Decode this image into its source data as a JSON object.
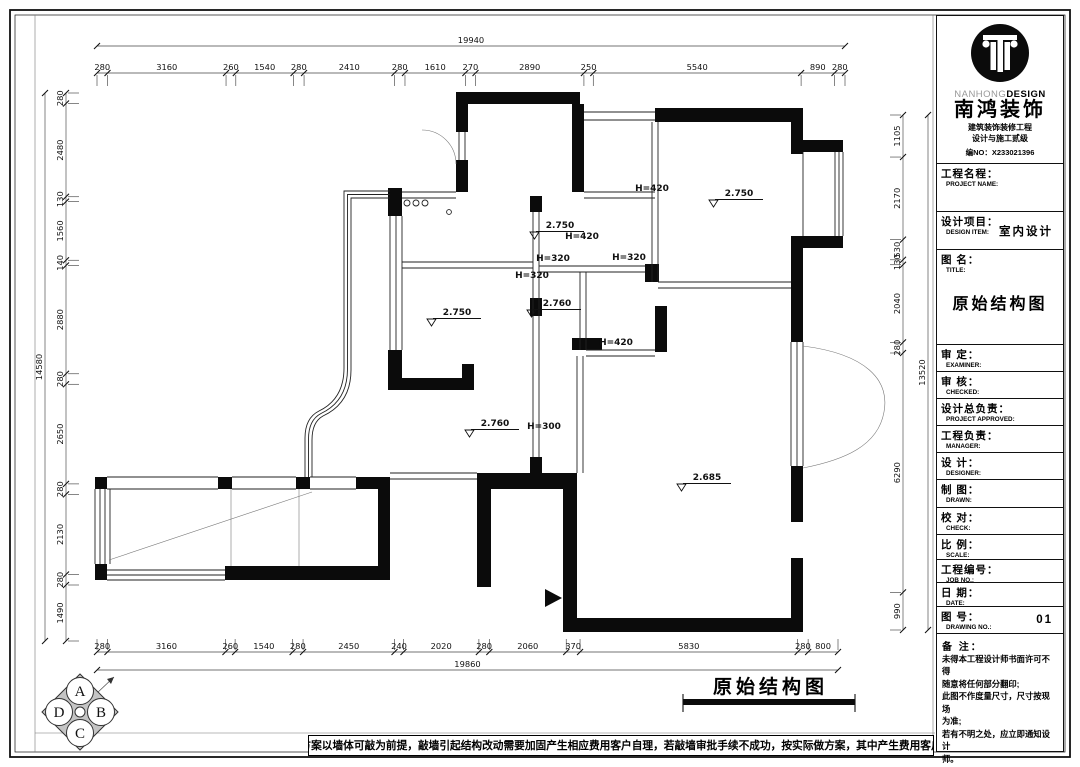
{
  "drawing_caption": "原始结构图",
  "footer_note": "提醒：方案以墙体可敲为前提，敲墙引起结构改动需要加固产生相应费用客户自理，若敲墙审批手续不成功，按实际做方案，其中产生费用客户自理。",
  "compass": {
    "top": "A",
    "right": "B",
    "bottom": "C",
    "left": "D"
  },
  "dimensions": {
    "top": {
      "overall": "19940",
      "segments": [
        "280",
        "3160",
        "260",
        "1540",
        "280",
        "2410",
        "280",
        "1610",
        "270",
        "2890",
        "250",
        "5540",
        "890",
        "280"
      ]
    },
    "bottom": {
      "overall": "19860",
      "segments": [
        "280",
        "3160",
        "260",
        "1540",
        "280",
        "2450",
        "240",
        "2020",
        "280",
        "2060",
        "370",
        "5830",
        "280",
        "800"
      ]
    },
    "left": {
      "overall": "14580",
      "segments": [
        "280",
        "2480",
        "130",
        "1560",
        "140",
        "2880",
        "280",
        "2650",
        "280",
        "2130",
        "280",
        "1490"
      ]
    },
    "right": {
      "overall": "13520",
      "segments": [
        "1105",
        "2170",
        "530",
        "130",
        "2040",
        "280",
        "6290",
        "990"
      ]
    }
  },
  "plan": {
    "levels": [
      {
        "value": "2.750",
        "x": 560,
        "y": 228
      },
      {
        "value": "2.750",
        "x": 739,
        "y": 196
      },
      {
        "value": "2.750",
        "x": 457,
        "y": 315
      },
      {
        "value": "2.760",
        "x": 557,
        "y": 306
      },
      {
        "value": "2.760",
        "x": 495,
        "y": 426
      },
      {
        "value": "2.685",
        "x": 707,
        "y": 480
      }
    ],
    "heights": [
      {
        "value": "H=420",
        "x": 582,
        "y": 239
      },
      {
        "value": "H=420",
        "x": 652,
        "y": 191
      },
      {
        "value": "H=420",
        "x": 616,
        "y": 345
      },
      {
        "value": "H=320",
        "x": 553,
        "y": 261
      },
      {
        "value": "H=320",
        "x": 629,
        "y": 260
      },
      {
        "value": "H=320",
        "x": 532,
        "y": 278
      },
      {
        "value": "H=300",
        "x": 544,
        "y": 429
      }
    ]
  },
  "title_block": {
    "brand_latin_light": "NANHONG",
    "brand_latin_bold": "DESIGN",
    "brand_cn": "南鸿装饰",
    "brand_sub1": "建筑装饰装修工程",
    "brand_sub2": "设计与施工贰级",
    "brand_no": "编NO：X233021396",
    "rows": [
      {
        "label": "工程名程：",
        "sub": "PROJECT NAME:",
        "value": ""
      },
      {
        "label": "设计项目：",
        "sub": "DESIGN ITEM:",
        "value": "室内设计"
      },
      {
        "label": "图 名：",
        "sub": "TITLE:",
        "value": "原始结构图"
      },
      {
        "label": "审 定：",
        "sub": "EXAMINER:",
        "value": ""
      },
      {
        "label": "审 核：",
        "sub": "CHECKED:",
        "value": ""
      },
      {
        "label": "设计总负责：",
        "sub": "PROJECT APPROVED:",
        "value": ""
      },
      {
        "label": "工程负责：",
        "sub": "MANAGER:",
        "value": ""
      },
      {
        "label": "设 计：",
        "sub": "DESIGNER:",
        "value": ""
      },
      {
        "label": "制 图：",
        "sub": "DRAWN:",
        "value": ""
      },
      {
        "label": "校 对：",
        "sub": "CHECK:",
        "value": ""
      },
      {
        "label": "比 例：",
        "sub": "SCALE:",
        "value": ""
      },
      {
        "label": "工程编号：",
        "sub": "JOB NO.:",
        "value": ""
      },
      {
        "label": "日 期：",
        "sub": "DATE:",
        "value": ""
      },
      {
        "label": "图 号：",
        "sub": "DRAWING NO.:",
        "value": "01"
      }
    ],
    "notes_title": "备 注：",
    "notes": [
      "未得本工程设计师书面许可不得",
      "随意将任何部分翻印;",
      "此图不作度量尺寸，尺寸按现场",
      "为准;",
      "若有不明之处，应立即通知设计",
      "师。"
    ],
    "notes_small": "本设计解释权归设计师所有。",
    "notes_phone": "免费质询电话:0571-85451647"
  }
}
